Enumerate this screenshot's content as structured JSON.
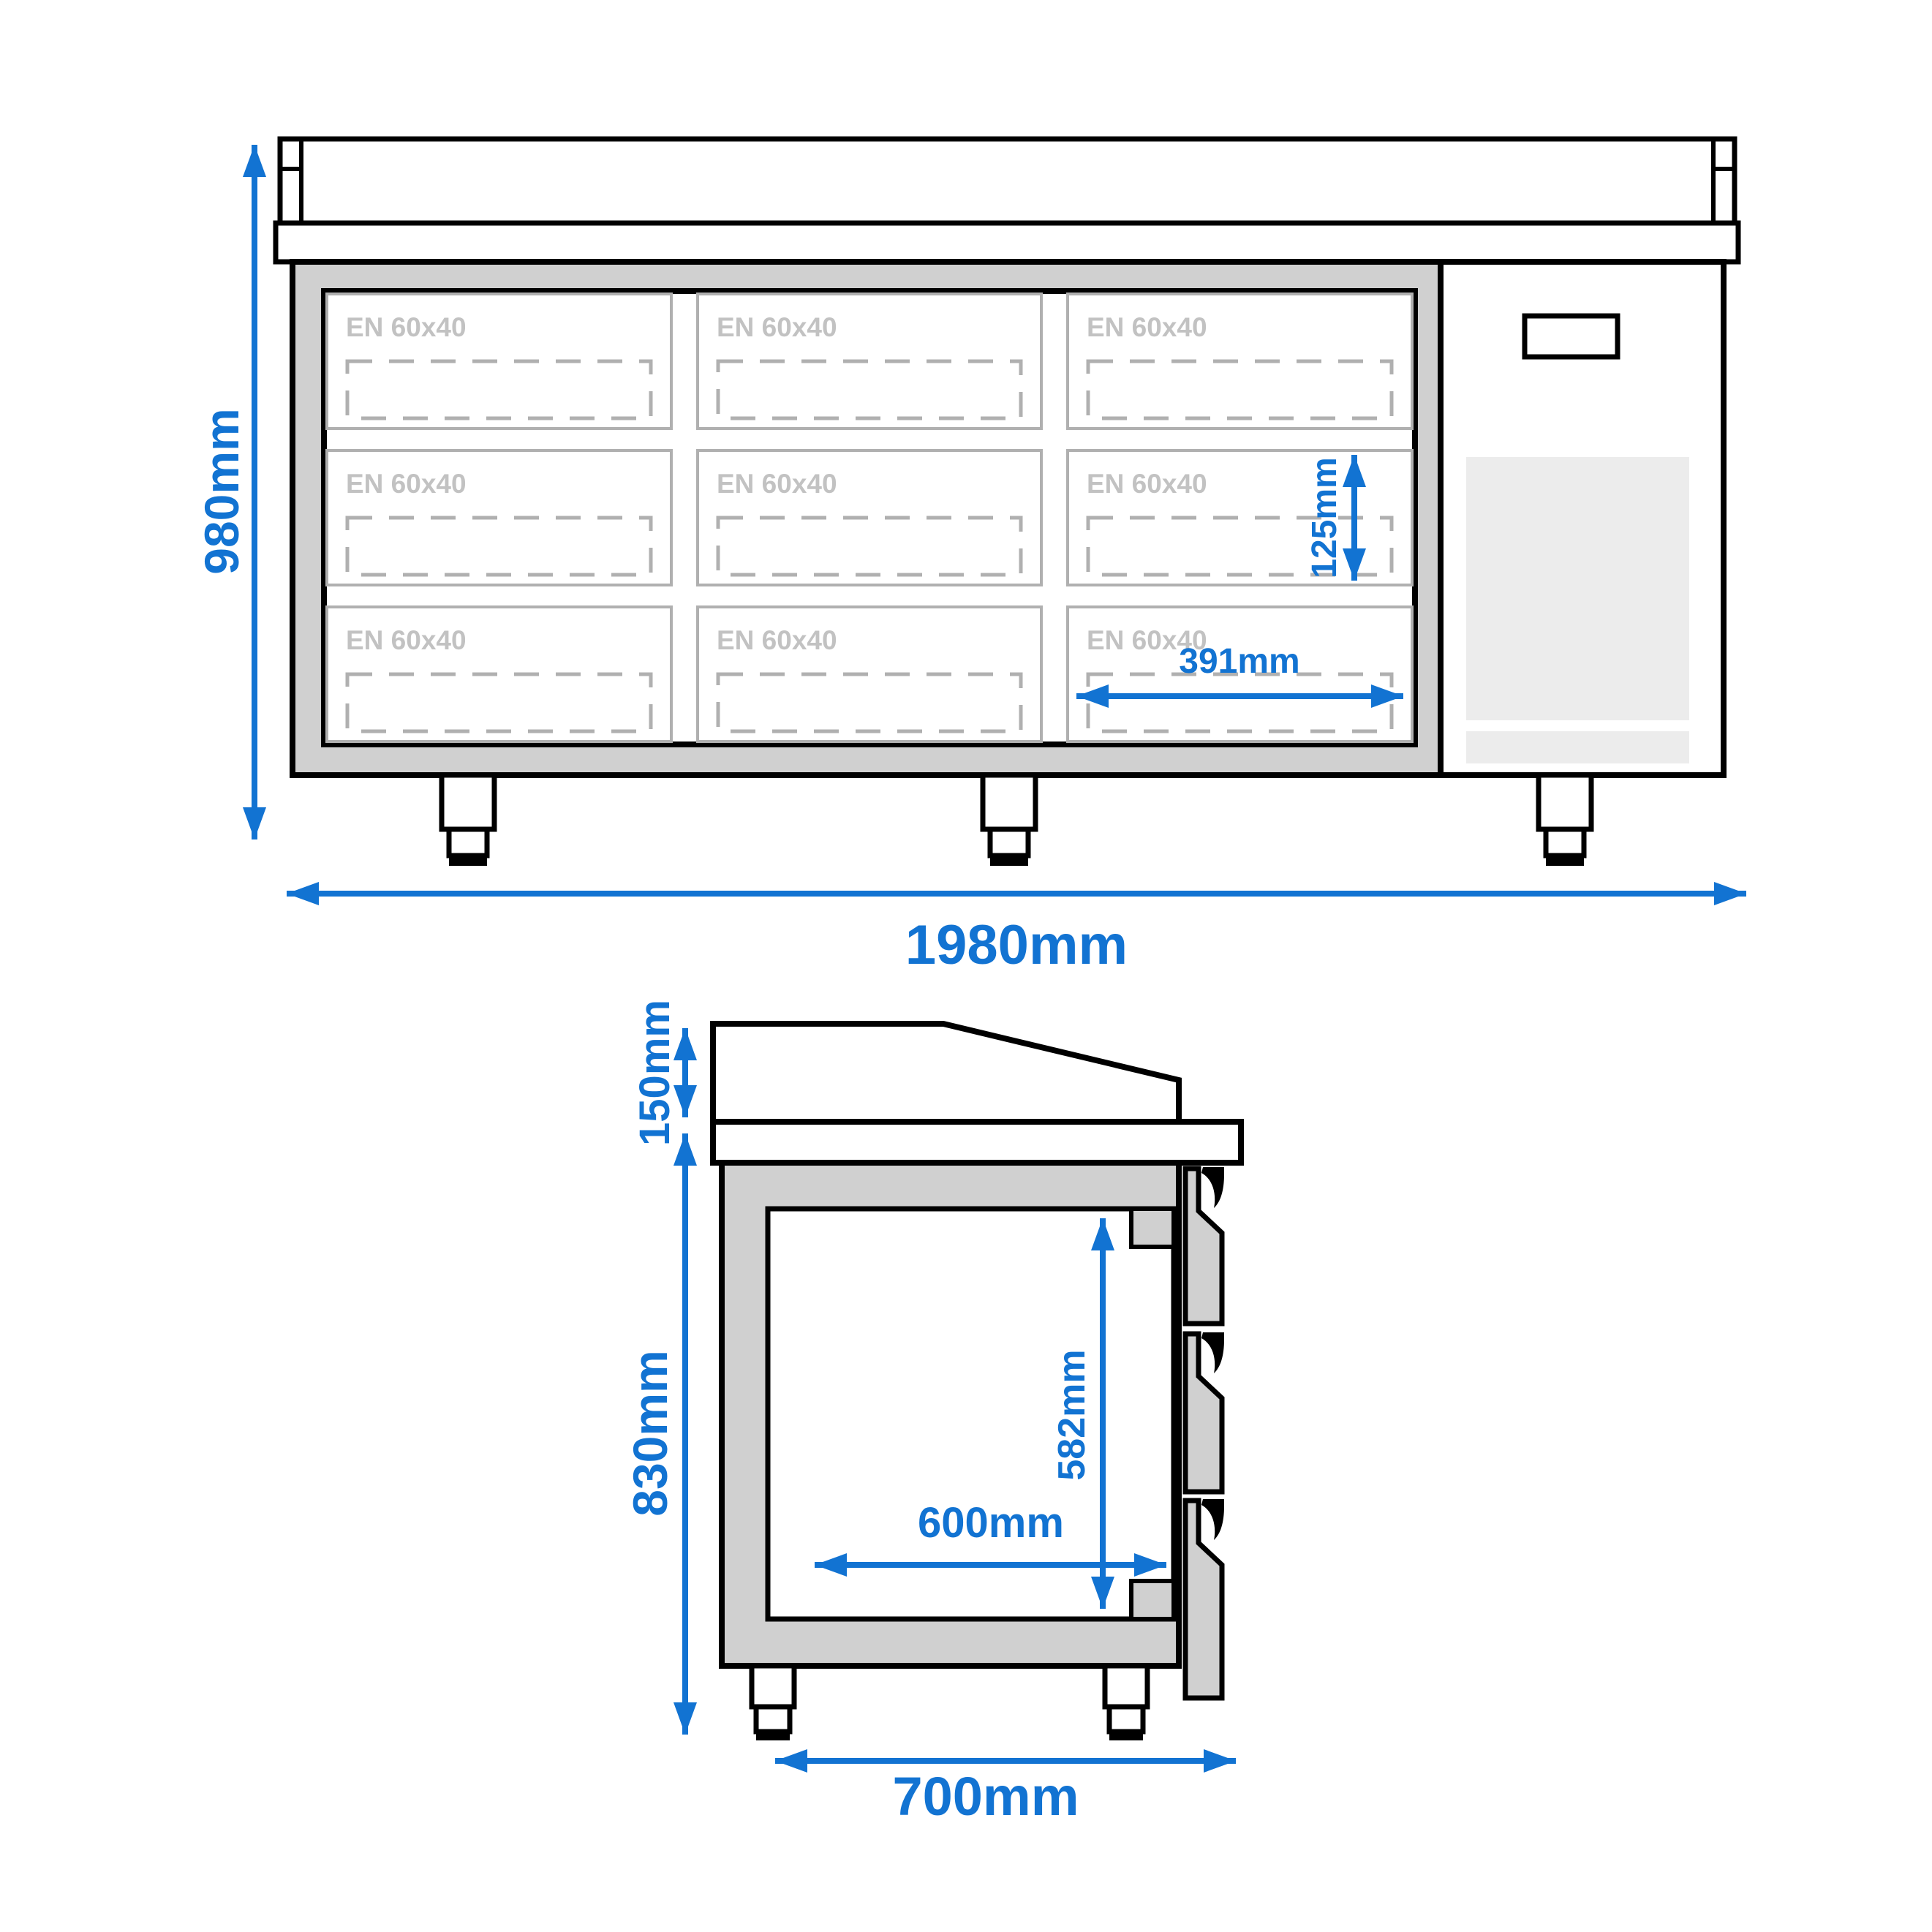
{
  "drawing": {
    "type": "technical dimension drawing",
    "subject": "refrigerated counter with drawers, front view and side section view"
  },
  "colors": {
    "dimension_blue": "#1273d2",
    "carcass_gray": "#d0d0d0",
    "cell_border_gray": "#b0b0b0",
    "compartment_label_gray": "#c2c2c2",
    "grille_gray": "#ececec",
    "outline_black": "#000000"
  },
  "front_view": {
    "overall_height_dim": "980mm",
    "overall_width_dim": "1980mm",
    "tray_pitch_dim": "125mm",
    "tray_width_dim": "391mm",
    "compartments": [
      {
        "label": "EN 60x40"
      },
      {
        "label": "EN 60x40"
      },
      {
        "label": "EN 60x40"
      },
      {
        "label": "EN 60x40"
      },
      {
        "label": "EN 60x40"
      },
      {
        "label": "EN 60x40"
      },
      {
        "label": "EN 60x40"
      },
      {
        "label": "EN 60x40"
      },
      {
        "label": "EN 60x40"
      }
    ]
  },
  "side_view": {
    "upstand_height_dim": "150mm",
    "body_height_dim": "830mm",
    "inner_width_dim": "600mm",
    "inner_height_dim": "582mm",
    "overall_depth_dim": "700mm"
  }
}
